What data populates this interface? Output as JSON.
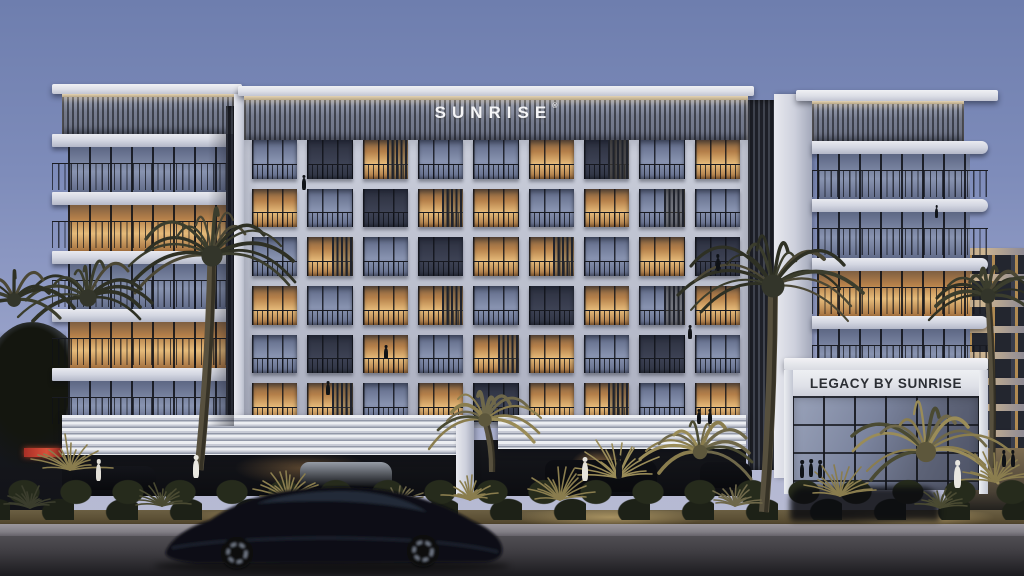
{
  "signs": {
    "roof_sign": {
      "text": "SUNRISE",
      "mark": "®"
    },
    "entrance_sign": {
      "text": "LEGACY BY SUNRISE"
    }
  },
  "palette": {
    "sky_top": "#6e7eae",
    "sky_horizon": "#babdd2",
    "concrete_light": "#e9eaf0",
    "concrete_frame": "#c2c6d5",
    "parapet_slats": "#7e8496",
    "glass_warm": "#e6bb7a",
    "glass_cool": "#8893b0",
    "glass_dark": "#323748",
    "road": "#2a292d",
    "foliage_dark": "#2e3024",
    "foliage_lit": "#8a7d4e",
    "sign_text_light": "#f5f5f7",
    "sign_text_dark": "#2b2e34",
    "shop_sign_red": "#d8503a"
  },
  "facade": {
    "center_grid": {
      "cols": 9,
      "rows": 6,
      "legend": {
        "w": "warm-lit window",
        "c": "cool reflective window",
        "d": "dark window",
        "uppercase": "louvered screen"
      },
      "cells": [
        "cdWccwDcw",
        "wcdWwcwCc",
        "cWcdwWcwd",
        "wcwWcdwCw",
        "cdwcWwcdc",
        "wWcwdwWcw"
      ]
    },
    "left_wing_floors": [
      "c",
      "w",
      "c",
      "w",
      "c"
    ],
    "right_wing_floors": [
      "c",
      "c",
      "w",
      "c",
      "w"
    ],
    "bg_right_building_floors": 8
  }
}
